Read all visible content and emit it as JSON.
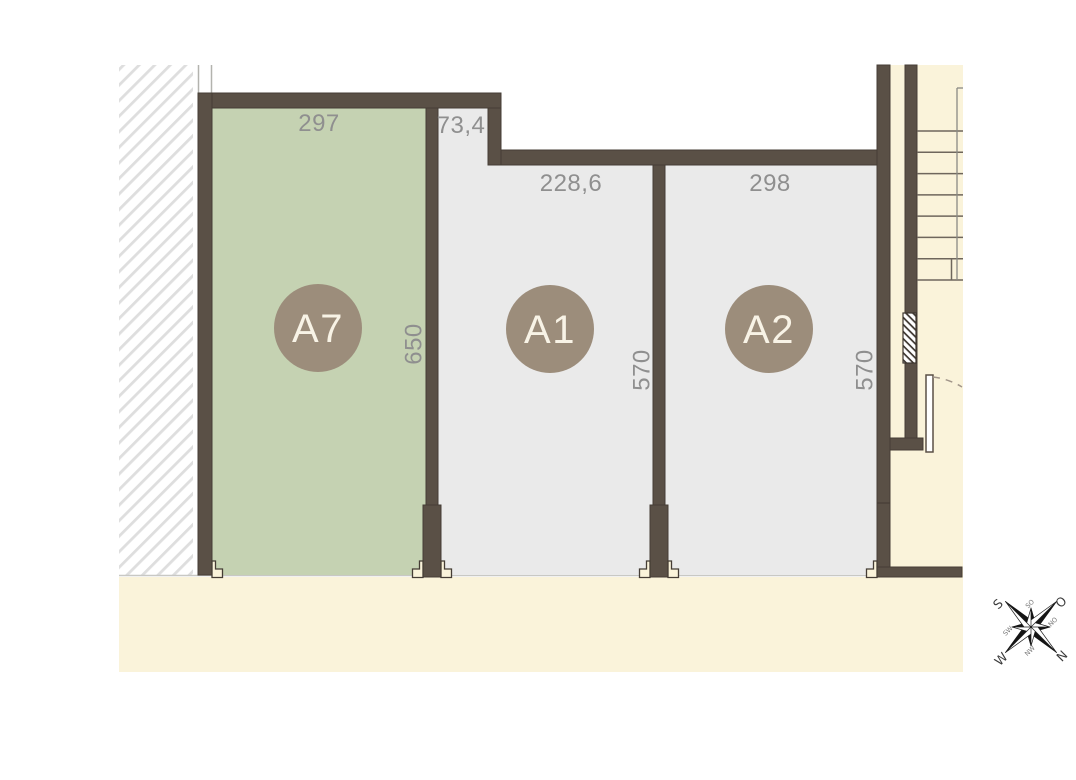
{
  "plan": {
    "units": [
      {
        "id": "a7",
        "label": "A7",
        "width": "297",
        "depth": "650"
      },
      {
        "id": "a1",
        "label": "A1",
        "width": "228,6",
        "depth": "570",
        "notch_width": "73,4"
      },
      {
        "id": "a2",
        "label": "A2",
        "width": "298",
        "depth": "570"
      }
    ],
    "compass": {
      "s": "S",
      "o": "O",
      "n": "N",
      "w": "W",
      "so": "SO",
      "no": "NO",
      "nw": "NW",
      "sw": "SW"
    },
    "colors": {
      "wall": "#5a5046",
      "unit_a7_fill": "#c5d2b2",
      "unit_fill": "#eaeaea",
      "outdoor": "#faf3da",
      "badge": "#9c8d7b",
      "dimension_text": "#8f8f8f"
    }
  }
}
